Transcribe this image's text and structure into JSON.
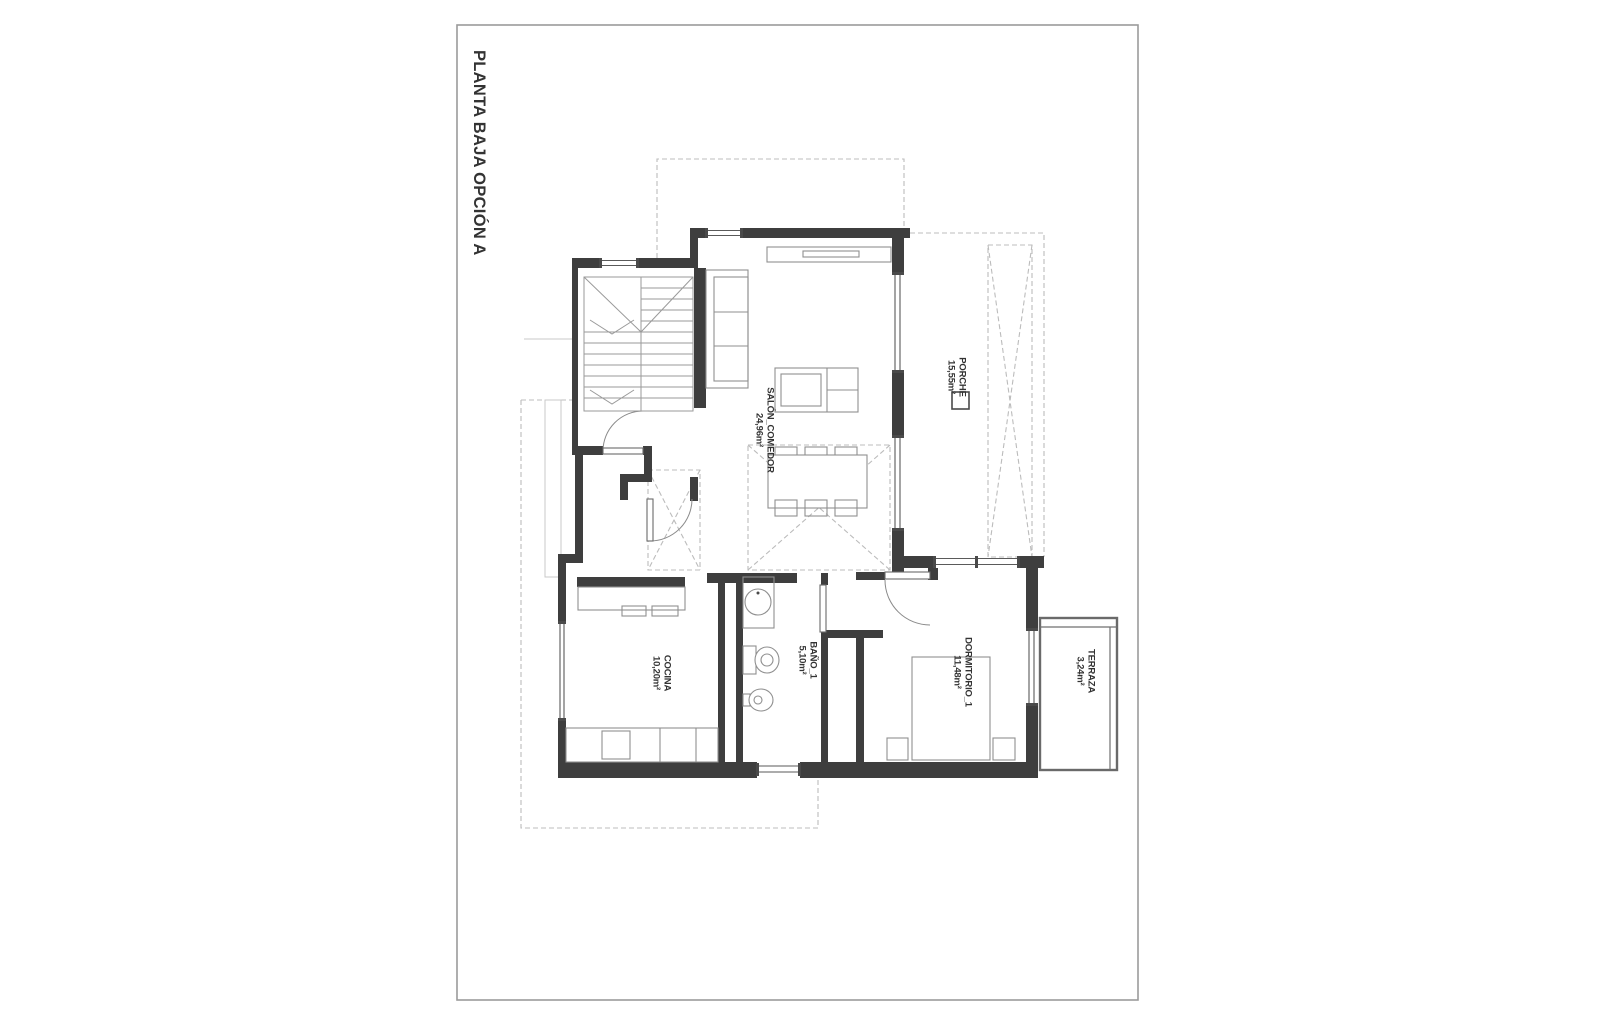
{
  "sheet": {
    "title": "PLANTA BAJA OPCIÓN A"
  },
  "plan": {
    "rooms": [
      {
        "id": "salon-comedor",
        "name": "SALÓN_COMEDOR",
        "area": "24,96m²"
      },
      {
        "id": "porche",
        "name": "PORCHE",
        "area": "15,55m²"
      },
      {
        "id": "cocina",
        "name": "COCINA",
        "area": "10,20m²"
      },
      {
        "id": "bano-1",
        "name": "BAÑO_1",
        "area": "5,10m²"
      },
      {
        "id": "dormitorio-1",
        "name": "DORMITORIO_1",
        "area": "11,48m²"
      },
      {
        "id": "terraza",
        "name": "TERRAZA",
        "area": "3,24m²"
      }
    ]
  },
  "colors": {
    "wall": "#3e3e3e",
    "furniture_line": "#8f8f8f",
    "dashed_line": "#bcbcbc",
    "sheet_border": "#9b9b9b",
    "label_text": "#333333"
  }
}
